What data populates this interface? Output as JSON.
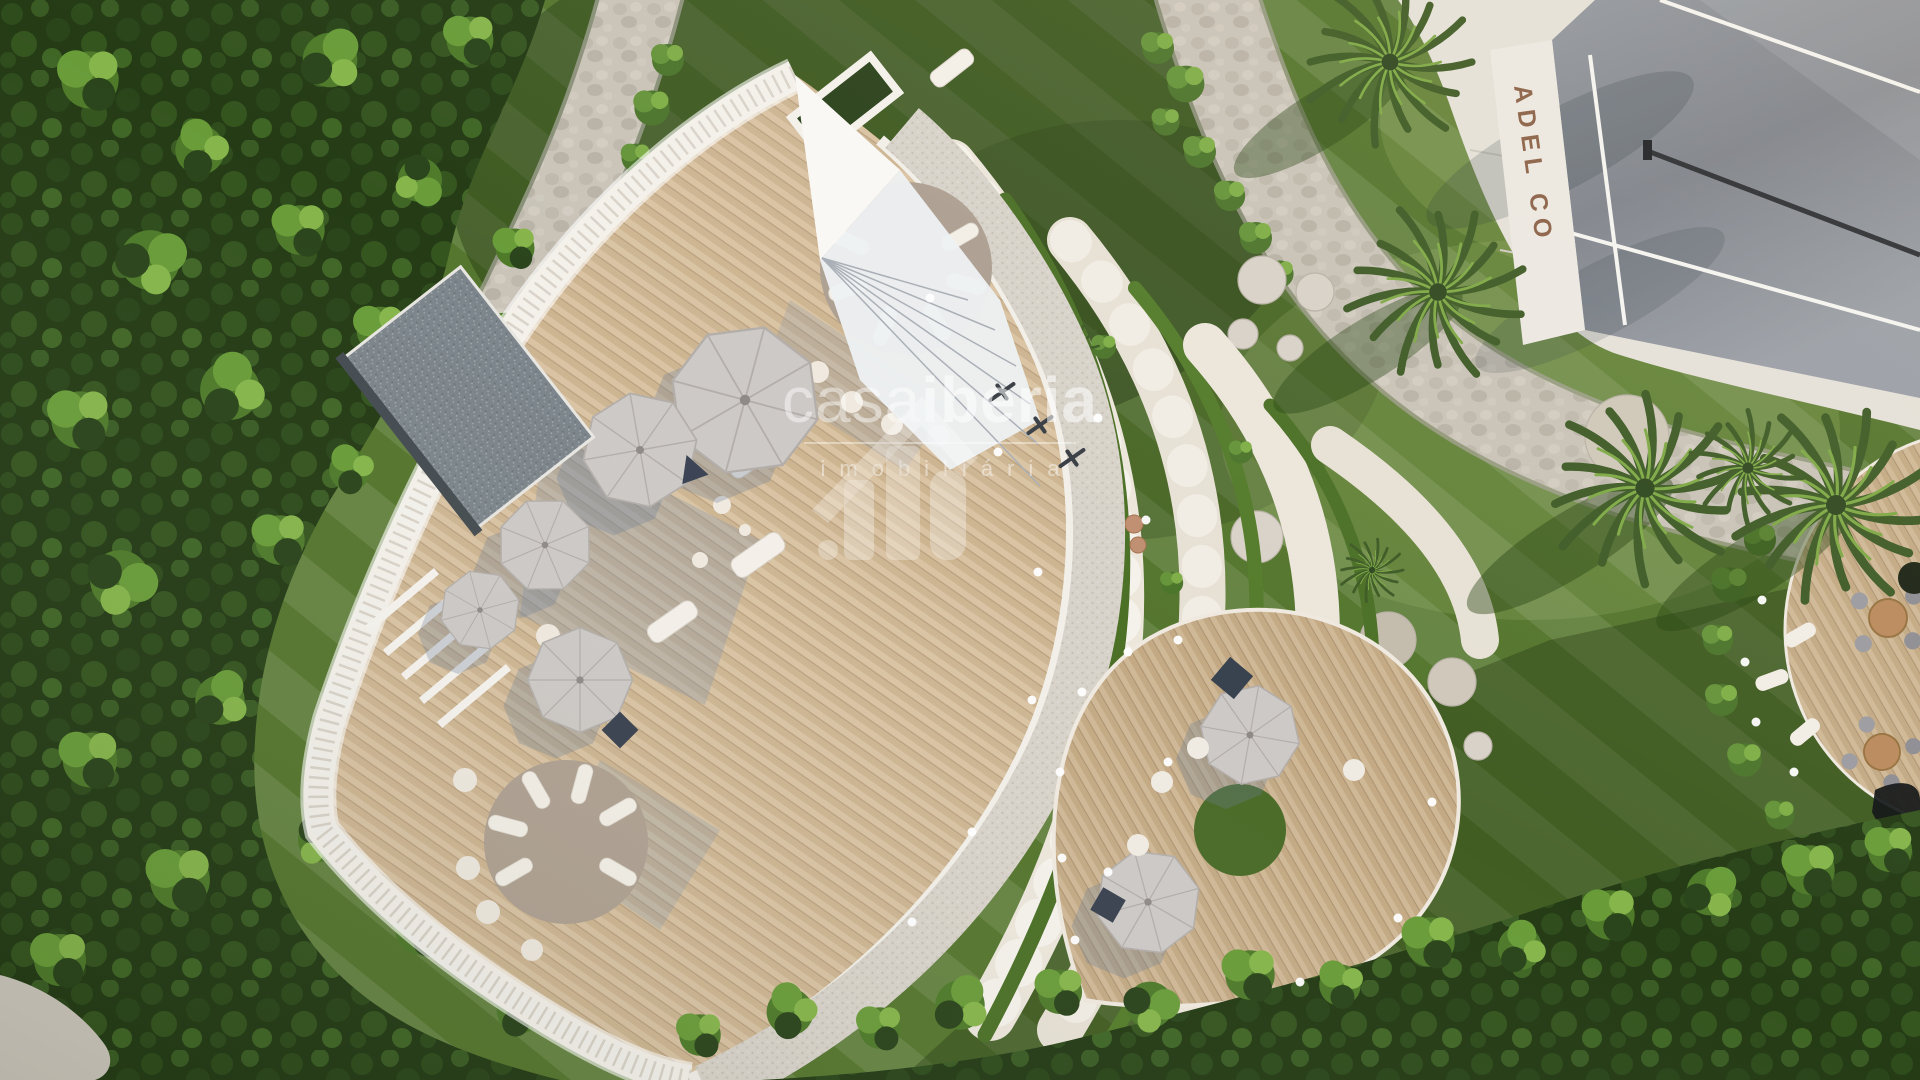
{
  "watermark": {
    "brand_light": "casa",
    "brand_bold": "iberia",
    "subtitle": "imobiliária",
    "logo_glyph": "house-skyline-glyph",
    "text_color": "#ffffff",
    "opacity": 0.55
  },
  "padel_court": {
    "signage_visible_text": "ADEL CO",
    "signage_color": "#7d4f33"
  },
  "palette": {
    "lawn_green": "#55762e",
    "forest_green": "#243b15",
    "hedge_green": "#4a7026",
    "stone_path": "#c9c3b8",
    "deck_wood": "#d9c3a3",
    "building_white": "#f4f1eb",
    "terrace_cream": "#ebe5da",
    "parasol_grey": "#cbc7c4",
    "platform_taupe": "#b5a797",
    "slate_platform": "#7c858b",
    "court_glass": "#868b94",
    "light_dot": "#ffffff"
  },
  "scene": {
    "type": "aerial-3d-architectural-render",
    "elements": [
      "forest",
      "striped-lawn",
      "stone-paths",
      "curved-leisure-deck-building",
      "parasols",
      "sun-loungers",
      "amphitheater-terraces",
      "hedge-arcs",
      "teardrop-deck",
      "padel-court",
      "palm-trees",
      "round-dining-deck",
      "stepping-stones",
      "garden-lights"
    ]
  }
}
